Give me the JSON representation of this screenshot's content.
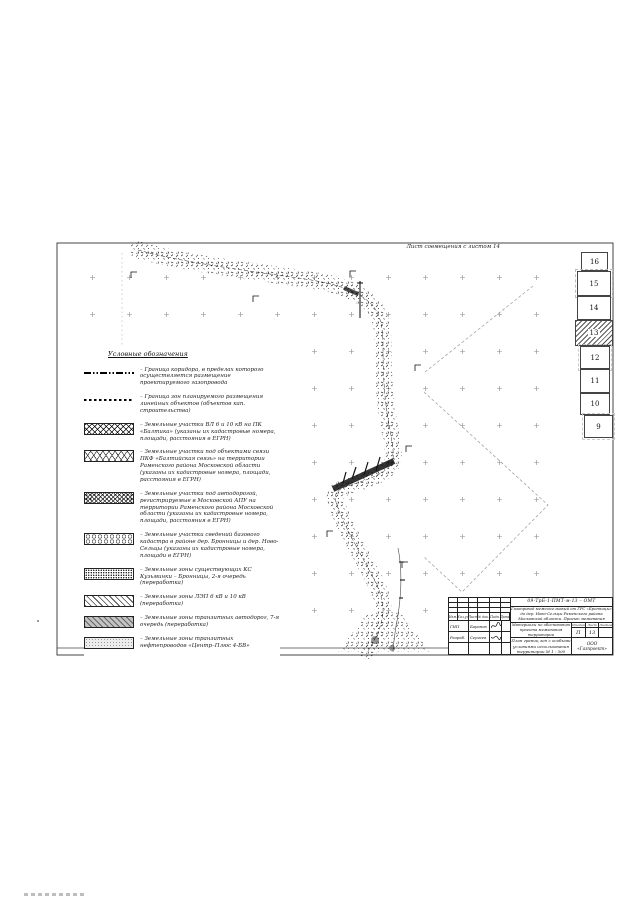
{
  "frame": {
    "top_label": "Лист совмещения с листом 14",
    "bottom_label": "Лист совмещения с листом 12"
  },
  "legend": {
    "title": "Условные обозначения",
    "items": [
      {
        "symbol": "dash-dot-line",
        "label": "– Граница коридора, в пределах которого осуществляется размещение проектируемого газопровода"
      },
      {
        "symbol": "dashed-line",
        "label": "– Граница зон планируемого размещения линейных объектов (объектов кап. строительства)"
      },
      {
        "symbol": "crosshatch-swatch",
        "label": "– Земельные участки ВЛ 6 и 10 кВ на ПК «Балтика» (указаны их кадастровые номера, площади, расстояния в ЕГРН)"
      },
      {
        "symbol": "lattice-swatch",
        "label": "– Земельные участки под объектами связи ПКФ «Балтийская связь» на территории Раменского района Московской области (указаны их кадастровые номера, площади, расстояния в ЕГРН)"
      },
      {
        "symbol": "dense-crosshatch-swatch",
        "label": "– Земельные участки под автодорогой, регистрируемые в Московской АПУ на территории Раменского района Московской области (указаны их кадастровые номера, площади, расстояния в ЕГРН)"
      },
      {
        "symbol": "pebble-swatch",
        "label": "– Земельные участки сведений базового кадастра в районе дер. Бронницы и дер. Ново-Сельцы (указаны их кадастровые номера, площади в ЕГРН)"
      },
      {
        "symbol": "dot-grid-swatch",
        "label": "– Земельные зоны существующих КС Кузьминки – Бронницы, 2-я очередь (переработка)"
      },
      {
        "symbol": "diagonal-swatch",
        "label": "– Земельные зоны ЛЭП 6 кВ и 10 кВ (переработка)"
      },
      {
        "symbol": "gray-diagonal-swatch",
        "label": "– Земельные зоны транзитных автодорог, 7-я очередь (переработка)"
      },
      {
        "symbol": "light-stipple-swatch",
        "label": "– Земельные зоны транзитных нефтепроводов «Центр–Плюс 4-БВ»"
      }
    ]
  },
  "sheet_index": {
    "sheets": [
      "16",
      "15",
      "14",
      "13",
      "12",
      "11",
      "10",
      "9"
    ],
    "current_sheet": "13"
  },
  "title_block": {
    "doc_number": "09-ТрБ-1-ПМТ-м-13 – ОМТ",
    "project_line1": "Газопровод межпоселковый от ГРС «Бронницы»",
    "project_line2": "до дер. Ново-Сельцы Раменского района",
    "project_line3": "Московской области. Проект межевания",
    "purpose_line1": "Материалы по обоснованию",
    "purpose_line2": "проекта межевания территории",
    "drawing_line1": "План границ зон с особыми условиями использования",
    "drawing_line2": "территории  М 1 : 500",
    "stage_label": "Стадия",
    "sheet_label": "Лист",
    "sheets_label": "Листов",
    "stage_value": "П",
    "sheet_value": "13",
    "sheets_value": "",
    "company_line1": "ООО",
    "company_line2": "«Газпроект»",
    "col_izm": "Изм.",
    "col_koluch": "Кол.уч",
    "col_list": "Лист",
    "col_ndok": "№ док.",
    "col_podp": "Подп.",
    "col_data": "Дата",
    "row1_role": "ГИП",
    "row1_name": "Баранов",
    "row2_role": "Разраб.",
    "row2_name": "Сергеев"
  }
}
